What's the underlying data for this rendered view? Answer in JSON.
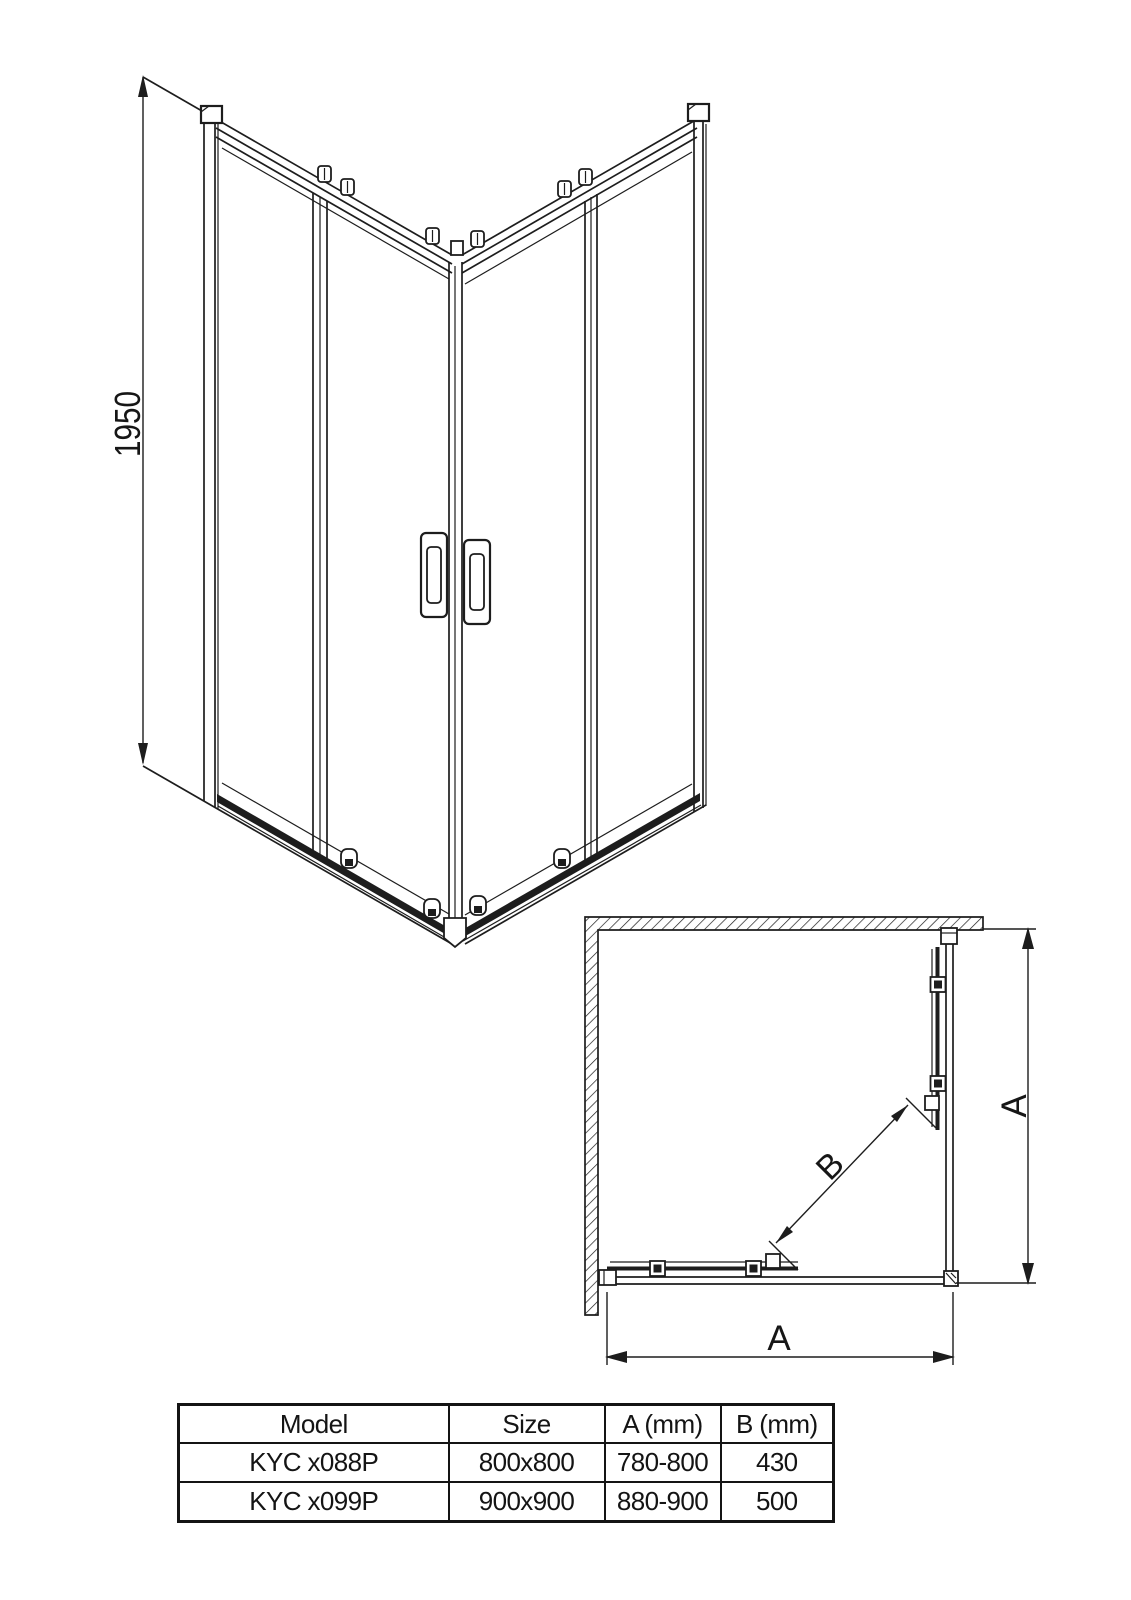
{
  "canvas": {
    "background": "#ffffff",
    "line_color": "#1d1d1d"
  },
  "front_view": {
    "height_dimension": "1950"
  },
  "plan_view": {
    "width_dimension": "A",
    "depth_dimension": "A",
    "diagonal_dimension": "B"
  },
  "spec_table": {
    "headers": [
      "Model",
      "Size",
      "A (mm)",
      "B (mm)"
    ],
    "rows": [
      {
        "model": "KYC x088P",
        "size": "800x800",
        "a_mm": "780-800",
        "b_mm": "430"
      },
      {
        "model": "KYC x099P",
        "size": "900x900",
        "a_mm": "880-900",
        "b_mm": "500"
      }
    ]
  }
}
